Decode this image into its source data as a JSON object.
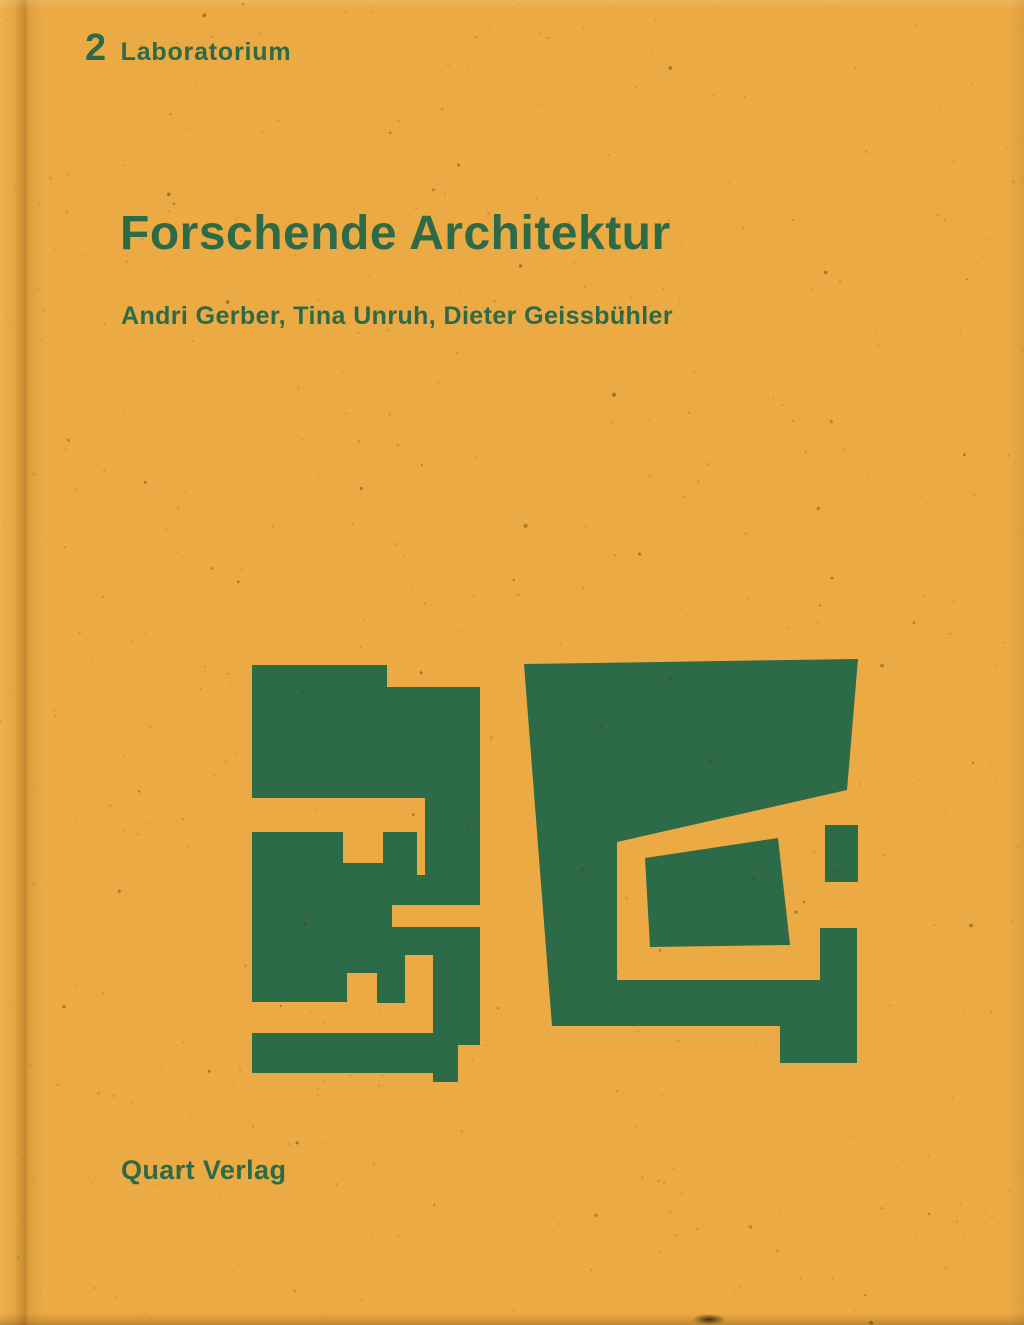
{
  "cover": {
    "series_number": "2",
    "series_name": "Laboratorium",
    "title": "Forschende Architektur",
    "authors": "Andri Gerber, Tina Unruh, Dieter Geissbühler",
    "publisher": "Quart Verlag"
  },
  "colors": {
    "background": "#ebaa43",
    "ink_green": "#2d6a47",
    "speckle": "#7a4c10"
  },
  "artwork": {
    "name": "abstract-floor-plan-figures",
    "left_figure_path": "M252,665 L387,665 L387,687 L480,687 L480,905 L392,905 L392,927 L480,927 L480,1045 L458,1045 L458,1082 L433,1082 L433,1073 L252,1073 L252,1033 L433,1033 L433,955 L405,955 L405,1003 L377,1003 L377,973 L347,973 L347,1002 L252,1002 L252,832 L343,832 L343,863 L383,863 L383,832 L417,832 L417,875 L425,875 L425,798 L252,798 Z",
    "right_figure_path": "M524,664 L858,659 L847,790 L617,842 L617,980 L820,980 L820,928 L857,928 L857,1063 L780,1063 L780,1026 L552,1026 Z",
    "right_inner_island_path": "M645,858 L778,838 L790,945 L650,947 Z",
    "right_detached_rect_path": "M825,825 L858,825 L858,882 L825,882 Z"
  }
}
